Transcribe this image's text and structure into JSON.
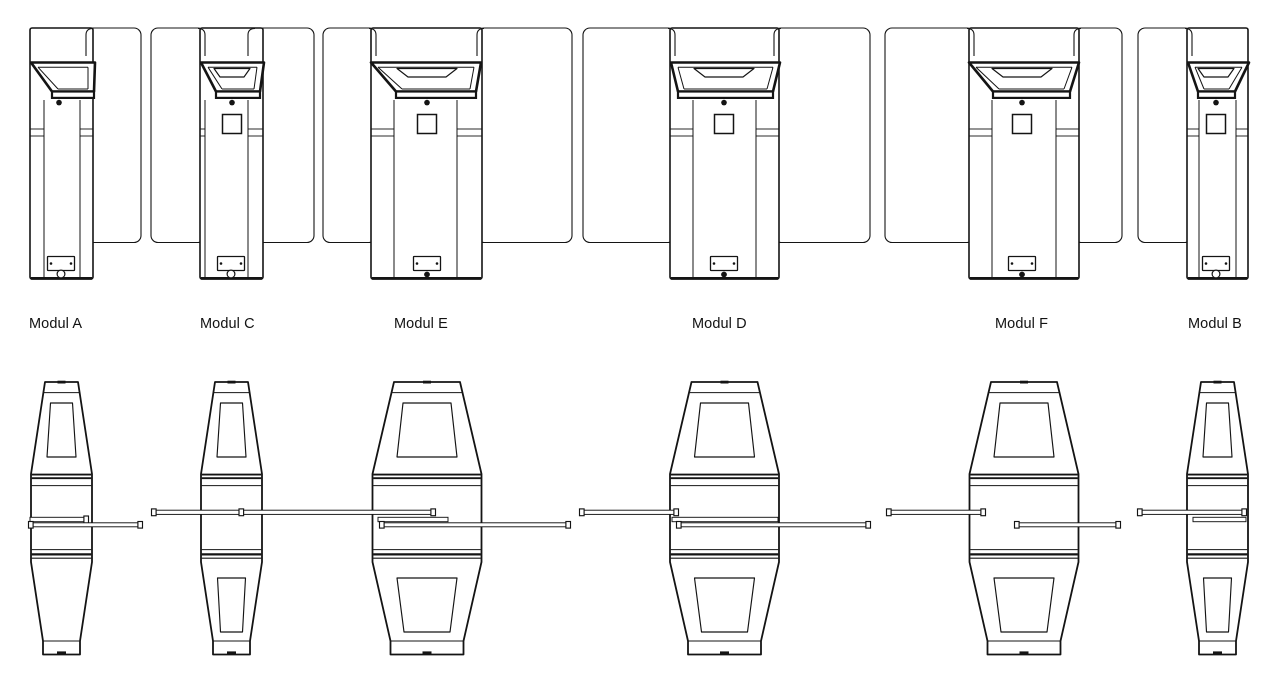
{
  "page": {
    "background": "#ffffff",
    "line_color": "#141414"
  },
  "diagram": {
    "kind": "technical-drawing",
    "subject": "Speed gate module variants",
    "views": [
      "plan-top-view",
      "front-profile-view"
    ]
  },
  "modules": [
    {
      "id": "a",
      "label": "Modul A",
      "label_x": 29,
      "plan": {
        "cab": [
          30,
          93
        ],
        "seams": [
          44,
          80
        ],
        "panel_left": null,
        "panel_right": [
          86,
          141
        ],
        "head_top": [
          31,
          95
        ],
        "head_band": [
          52,
          94
        ],
        "head_window": false,
        "head_dot_x": 59,
        "display_square": false,
        "bottom_center_x": 61,
        "bottom_mark": "circle"
      },
      "profile": {
        "cx": 61.5,
        "size": "narrow",
        "upper_window": true,
        "lower_window": false
      },
      "wing_bars": [
        {
          "level": "inner",
          "x1": 30,
          "x2": 88,
          "cap_left": false,
          "cap_right": true
        },
        {
          "level": "lower",
          "x1": 29,
          "x2": 142,
          "cap_left": true,
          "cap_right": true
        }
      ]
    },
    {
      "id": "c",
      "label": "Modul C",
      "label_x": 200,
      "plan": {
        "cab": [
          200,
          263
        ],
        "seams": [
          205,
          248
        ],
        "panel_left": [
          151,
          205
        ],
        "panel_right": [
          248,
          314
        ],
        "head_top": [
          201,
          264
        ],
        "head_band": [
          216,
          260
        ],
        "head_window": true,
        "head_dot_x": 232,
        "display_square": true,
        "bottom_center_x": 231,
        "bottom_mark": "circle"
      },
      "profile": {
        "cx": 231.5,
        "size": "narrow",
        "upper_window": true,
        "lower_window": true
      },
      "wing_bars": [
        {
          "level": "upper",
          "x1": 152,
          "x2": 435,
          "cap_left": true,
          "cap_right": true,
          "mid_caps": [
            239
          ]
        }
      ]
    },
    {
      "id": "e",
      "label": "Modul E",
      "label_x": 394,
      "plan": {
        "cab": [
          371,
          482
        ],
        "seams": [
          394,
          457
        ],
        "panel_left": [
          323,
          376
        ],
        "panel_right": [
          477,
          572
        ],
        "head_top": [
          371,
          481
        ],
        "head_band": [
          396,
          476
        ],
        "head_window": true,
        "head_dot_x": 427,
        "display_square": true,
        "bottom_center_x": 427,
        "bottom_mark": "dot"
      },
      "profile": {
        "cx": 427,
        "size": "wide",
        "upper_window": true,
        "lower_window": true
      },
      "wing_bars": [
        {
          "level": "inner",
          "x1": 378,
          "x2": 448,
          "cap_left": false,
          "cap_right": false
        },
        {
          "level": "lower",
          "x1": 380,
          "x2": 570,
          "cap_left": true,
          "cap_right": true
        }
      ]
    },
    {
      "id": "d",
      "label": "Modul D",
      "label_x": 692,
      "plan": {
        "cab": [
          670,
          779
        ],
        "seams": [
          693,
          756
        ],
        "panel_left": [
          583,
          675
        ],
        "panel_right": [
          774,
          870
        ],
        "head_top": [
          671,
          780
        ],
        "head_band": [
          678,
          773
        ],
        "head_window": true,
        "head_dot_x": 724,
        "display_square": true,
        "bottom_center_x": 724,
        "bottom_mark": "dot"
      },
      "profile": {
        "cx": 724.5,
        "size": "wide",
        "upper_window": true,
        "lower_window": true
      },
      "wing_bars": [
        {
          "level": "upper",
          "x1": 580,
          "x2": 678,
          "cap_left": true,
          "cap_right": true
        },
        {
          "level": "inner",
          "x1": 672,
          "x2": 778,
          "cap_left": false,
          "cap_right": false
        },
        {
          "level": "lower",
          "x1": 677,
          "x2": 870,
          "cap_left": true,
          "cap_right": true
        }
      ]
    },
    {
      "id": "f",
      "label": "Modul F",
      "label_x": 995,
      "plan": {
        "cab": [
          969,
          1079
        ],
        "seams": [
          992,
          1056
        ],
        "panel_left": [
          885,
          974
        ],
        "panel_right": [
          1074,
          1122
        ],
        "head_top": [
          969,
          1079
        ],
        "head_band": [
          993,
          1070
        ],
        "head_window": true,
        "head_dot_x": 1022,
        "display_square": true,
        "bottom_center_x": 1022,
        "bottom_mark": "dot"
      },
      "profile": {
        "cx": 1024,
        "size": "wide",
        "upper_window": true,
        "lower_window": true
      },
      "wing_bars": [
        {
          "level": "upper",
          "x1": 887,
          "x2": 985,
          "cap_left": true,
          "cap_right": true
        },
        {
          "level": "lower",
          "x1": 1015,
          "x2": 1120,
          "cap_left": true,
          "cap_right": true
        }
      ]
    },
    {
      "id": "b",
      "label": "Modul B",
      "label_x": 1188,
      "plan": {
        "cab": [
          1187,
          1248
        ],
        "seams": [
          1199,
          1236
        ],
        "panel_left": [
          1138,
          1192
        ],
        "panel_right": null,
        "head_top": [
          1188,
          1249
        ],
        "head_band": [
          1198,
          1235
        ],
        "head_window": true,
        "head_dot_x": 1216,
        "display_square": true,
        "bottom_center_x": 1216,
        "bottom_mark": "circle"
      },
      "profile": {
        "cx": 1217.5,
        "size": "narrow",
        "upper_window": true,
        "lower_window": true
      },
      "wing_bars": [
        {
          "level": "upper",
          "x1": 1138,
          "x2": 1246,
          "cap_left": true,
          "cap_right": true
        },
        {
          "level": "inner",
          "x1": 1193,
          "x2": 1246,
          "cap_left": false,
          "cap_right": false
        }
      ]
    }
  ]
}
